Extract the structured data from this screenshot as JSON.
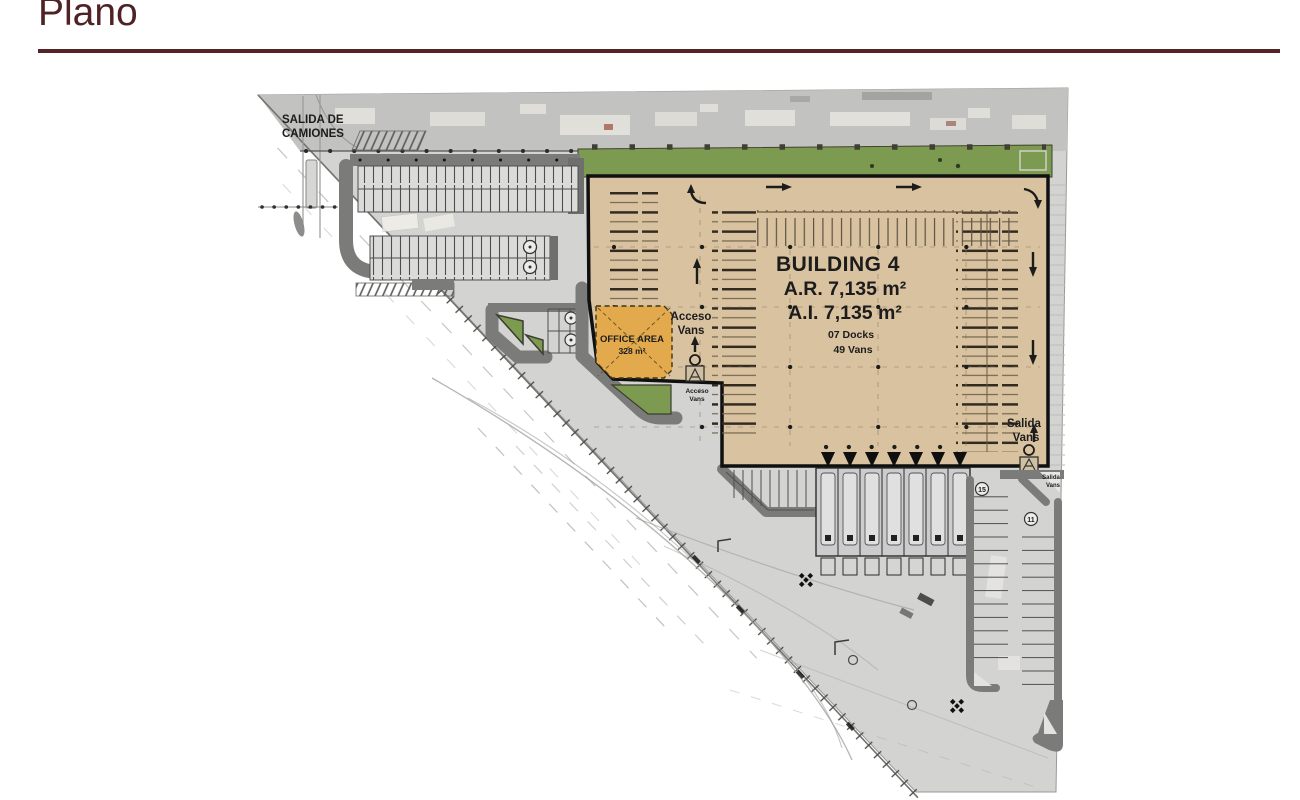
{
  "slide": {
    "title": "Plano",
    "accent_color": "#542327"
  },
  "plan": {
    "site_labels": {
      "salida_camiones_line1": "SALIDA DE",
      "salida_camiones_line2": "CAMIONES"
    },
    "building": {
      "name": "BUILDING 4",
      "roof_area": "A.R. 7,135 m²",
      "interior_area": "A.I.  7,135 m²",
      "docks": "07 Docks",
      "vans": "49 Vans"
    },
    "office": {
      "line1": "OFFICE AREA",
      "line2": "328 m²"
    },
    "access": {
      "acceso_line1": "Acceso",
      "acceso_line2": "Vans",
      "acceso_small_line1": "Acceso",
      "acceso_small_line2": "Vans",
      "salida_line1": "Salida",
      "salida_line2": "Vans",
      "salida_small_line1": "Salida",
      "salida_small_line2": "Vans"
    },
    "parking": {
      "row_count_left": "15",
      "row_count_right": "11"
    },
    "colors": {
      "site": "#d3d3d1",
      "road_dark": "#7b7b79",
      "building_fill": "#d8c2a0",
      "office_fill": "#e3aa4d",
      "landscape_green": "#7c9a50",
      "accent": "#542327"
    }
  }
}
